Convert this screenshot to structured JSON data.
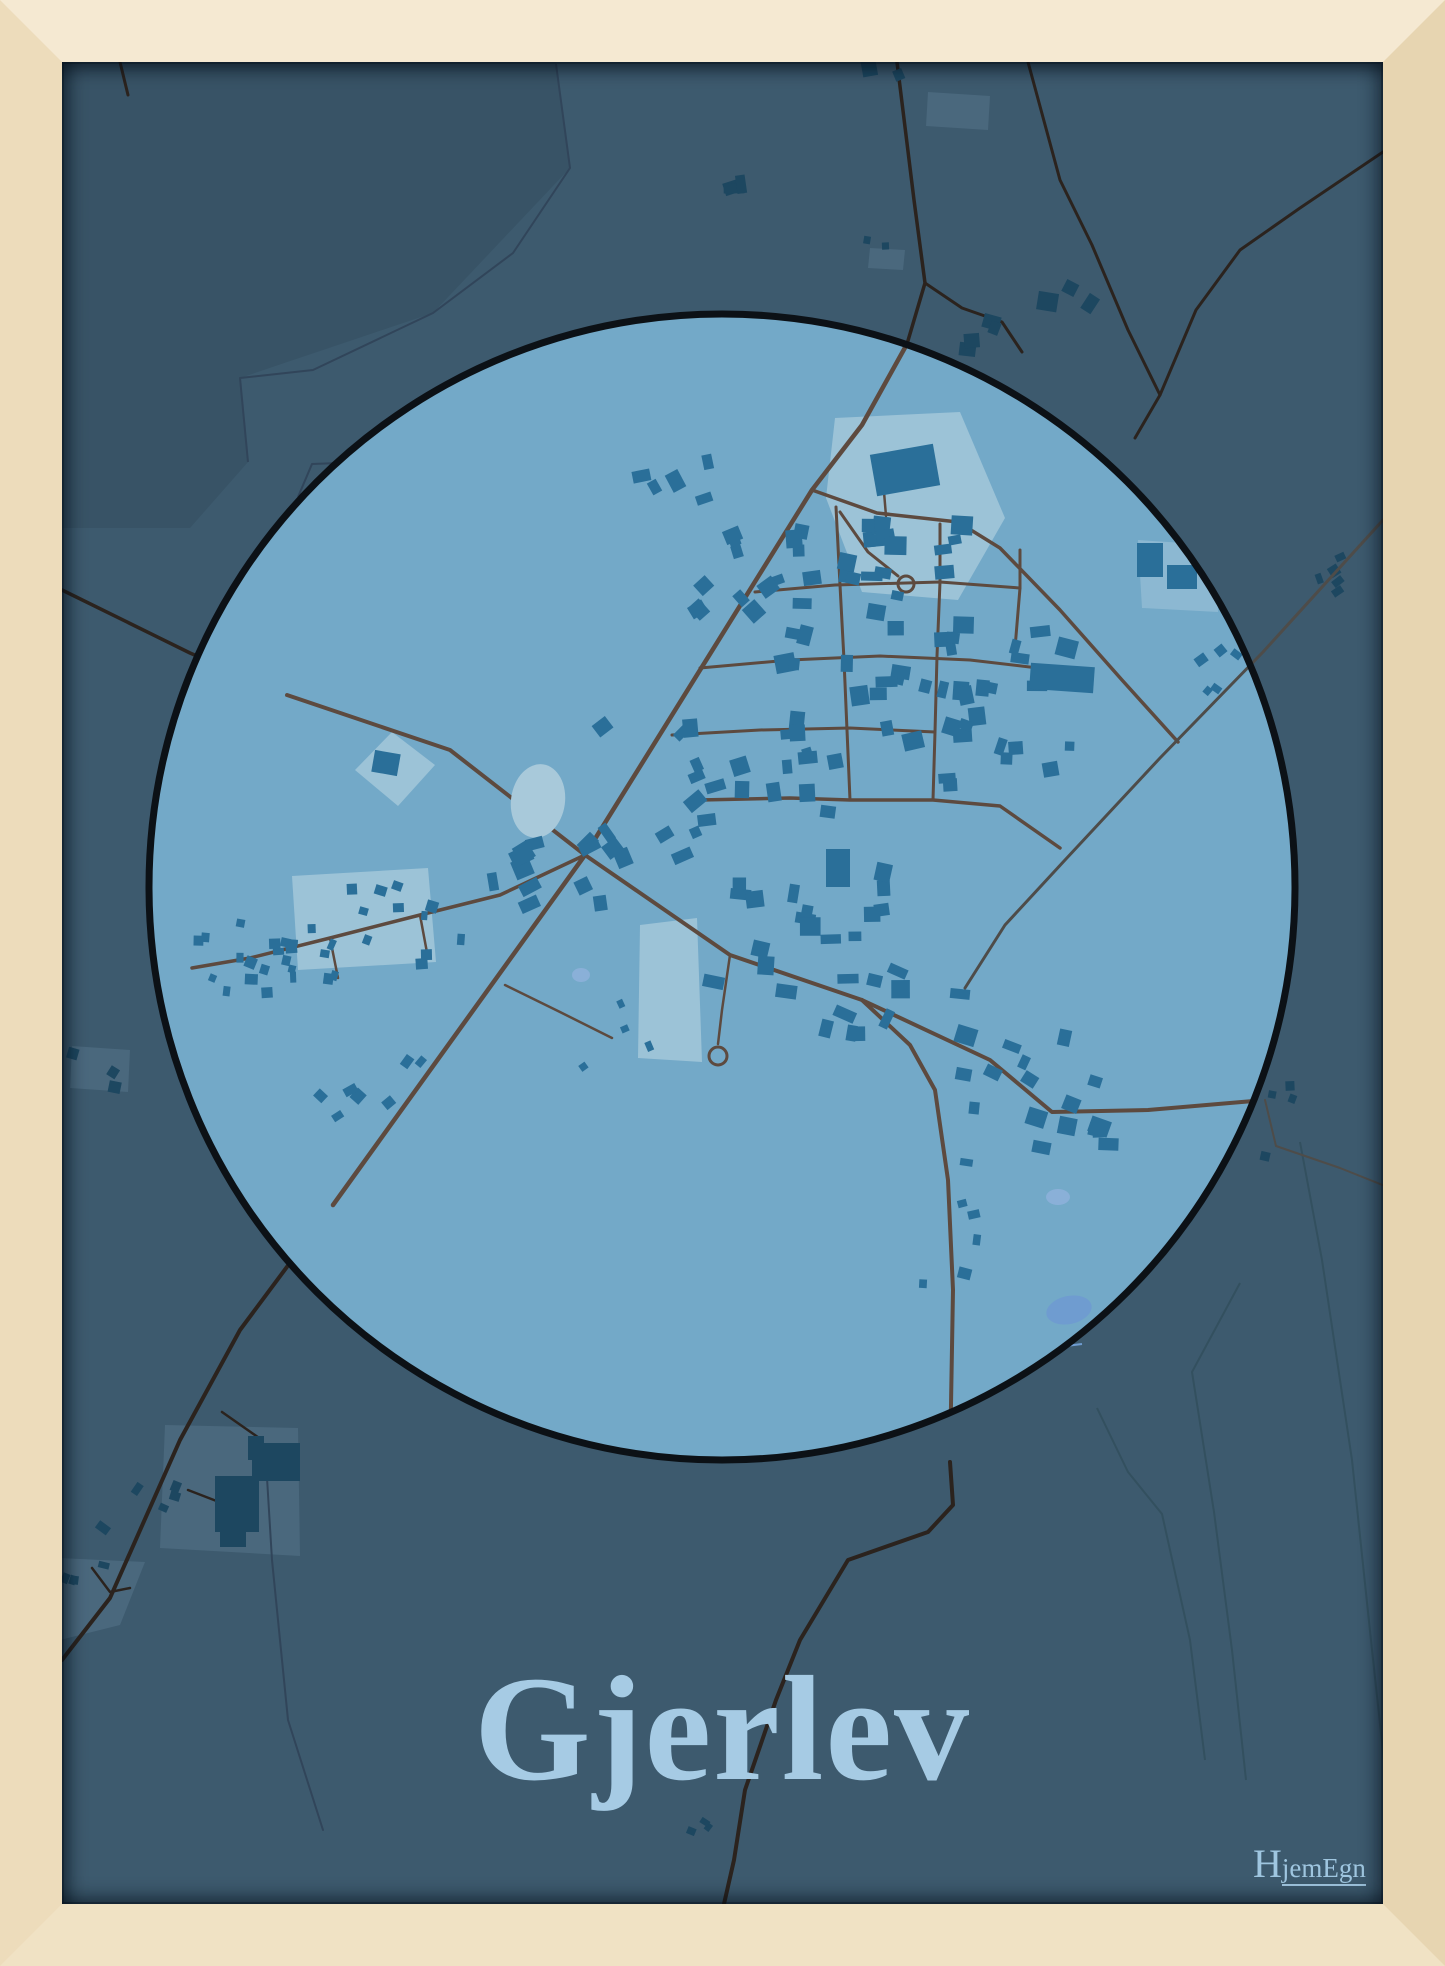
{
  "poster": {
    "title": "Gjerlev",
    "brand": {
      "first_letter": "H",
      "rest": "jemEgn"
    }
  },
  "colors": {
    "frame_top": "#f5e9d2",
    "frame_left": "#eddcbb",
    "frame_right": "#e7d5b1",
    "frame_bottom": "#f0e2c4",
    "poster_bg": "#3d5a6e",
    "overlay_dark": "rgba(16,28,38,0.10)",
    "circle_fill": "#73a9c8",
    "circle_outline": "#0c1116",
    "building_in": "#2a6f99",
    "building_out": "#1d4760",
    "patch_in": "#a5c8db",
    "patch_out": "#4b697e",
    "road_in": "#5d4a3f",
    "road_out": "#2b231e",
    "road_gray": "#4e4c49",
    "stream": "#31455a",
    "field_line": "#33505f",
    "pond": "#a8c9da",
    "lake1": "#6f9cd0",
    "lake2": "#8ab0d8",
    "title_color": "#a6cbe4",
    "brand_color": "#9fc6e0"
  },
  "map": {
    "viewbox": "62 62 1321 1842",
    "circle": {
      "cx": 722,
      "cy": 887,
      "r": 573,
      "outline_width": 7
    },
    "dark_overlay": "62,62 556,62 570,168 433,313 240,378 248,462 190,528 62,528",
    "streams": [
      {
        "pts": "556,64 570,168 513,253 433,313 313,370 240,378 248,462",
        "w": 2
      },
      {
        "pts": "467,402 417,460 312,464 298,497",
        "w": 2
      },
      {
        "pts": "1036,1338 1058,1347 1082,1344",
        "w": 2,
        "col": "lake1"
      }
    ],
    "field_lines": [
      "1240,1283 1192,1372 1214,1512 1232,1650 1246,1780",
      "1097,1408 1128,1472 1162,1514 1190,1640 1205,1760",
      "1300,1142 1322,1260 1352,1460 1372,1650 1385,1770"
    ],
    "roads_out": [
      {
        "pts": "897,62 914,200 925,283 907,344",
        "w": 3.5
      },
      {
        "pts": "925,283 962,308 1002,322 1022,352",
        "w": 3
      },
      {
        "pts": "1028,62 1060,180 1092,245 1128,330 1160,395 1135,438",
        "w": 3
      },
      {
        "pts": "1383,152 1300,208 1240,250 1196,310 1160,395",
        "w": 3
      },
      {
        "pts": "120,62 128,95",
        "w": 3
      },
      {
        "pts": "950,1462 953,1505 928,1532 848,1560 800,1640 776,1700 745,1790 734,1860 724,1904",
        "w": 4
      },
      {
        "pts": "333,1205 240,1330 180,1440 110,1598 62,1660",
        "w": 4
      },
      {
        "pts": "188,1490 245,1512",
        "w": 2.5
      },
      {
        "pts": "222,1412 262,1440 258,1470",
        "w": 2.5
      },
      {
        "pts": "92,1568 110,1592 130,1588",
        "w": 2.5
      },
      {
        "pts": "62,590 190,653 287,695",
        "w": 3.5
      },
      {
        "pts": "265,1445 272,1560 288,1720 323,1830",
        "w": 2,
        "col": "stream"
      },
      {
        "pts": "1265,1100 1276,1146 1340,1168 1385,1186",
        "w": 2,
        "col": "road_gray"
      }
    ],
    "roads_mid": [
      {
        "pts": "1383,520 1263,652 1160,758 1065,860 1005,925 965,988",
        "w": 3,
        "col": "road_gray"
      }
    ],
    "roads_in": [
      {
        "pts": "907,344 862,425 812,490 585,855 333,1205",
        "w": 4.5
      },
      {
        "pts": "287,695 450,750 585,855 730,955 862,1000 990,1060 1052,1112 1148,1110 1265,1100",
        "w": 4
      },
      {
        "pts": "812,490 877,513 958,522 1000,548 1060,610 1122,680 1178,742",
        "w": 3.5
      },
      {
        "pts": "840,512 868,552 898,576",
        "w": 3
      },
      {
        "pts": "884,492 886,516",
        "w": 2.5
      },
      {
        "pts": "755,592 835,585 940,582 1020,588",
        "w": 3
      },
      {
        "pts": "700,668 790,660 880,656 970,660 1038,668",
        "w": 3
      },
      {
        "pts": "672,735 760,730 850,728 935,732",
        "w": 3
      },
      {
        "pts": "836,507 840,585 844,660 847,730 850,800",
        "w": 3
      },
      {
        "pts": "940,524 940,582 937,656 935,732 933,800",
        "w": 3
      },
      {
        "pts": "1020,550 1020,588 1014,660",
        "w": 3
      },
      {
        "pts": "700,800 790,798 850,800 933,800 1000,806 1060,848",
        "w": 3.5
      },
      {
        "pts": "585,855 500,895 420,915 330,938 250,958 192,968",
        "w": 3.5
      },
      {
        "pts": "862,1000 910,1045 935,1090 948,1180 953,1290 950,1462",
        "w": 4
      },
      {
        "pts": "730,955 722,1010 718,1044",
        "w": 2.5
      },
      {
        "pts": "505,985 560,1012 612,1038",
        "w": 2.5
      },
      {
        "pts": "330,938 338,978",
        "w": 2.5
      },
      {
        "pts": "420,915 428,958",
        "w": 2.5
      }
    ],
    "culdesacs": [
      {
        "cx": 906,
        "cy": 584,
        "r": 8
      },
      {
        "cx": 718,
        "cy": 1056,
        "r": 9
      }
    ],
    "patches_in": [
      {
        "pts": "835,418 960,412 1005,518 958,600 862,592 826,498",
        "op": 0.82
      },
      {
        "pts": "292,876 428,868 436,962 298,970",
        "op": 0.82
      },
      {
        "pts": "355,770 392,732 435,765 398,806",
        "op": 0.82
      },
      {
        "pts": "640,925 697,918 702,1062 638,1058",
        "op": 0.82
      },
      {
        "pts": "1138,540 1215,545 1218,612 1142,608",
        "op": 0.5
      }
    ],
    "patches_out": [
      {
        "pts": "870,248 905,250 903,270 868,268",
        "op": 0.9
      },
      {
        "pts": "928,92 990,96 988,130 926,126",
        "op": 0.9
      },
      {
        "pts": "165,1425 298,1428 300,1556 160,1548",
        "op": 0.9
      },
      {
        "pts": "72,1046 130,1050 128,1092 70,1088",
        "op": 0.9
      },
      {
        "pts": "60,1558 145,1562 120,1625 60,1640",
        "op": 0.9
      }
    ],
    "lakes": [
      {
        "cx": 538,
        "cy": 801,
        "rx": 27,
        "ry": 37,
        "rot": 8,
        "fill": "pond"
      },
      {
        "cx": 1069,
        "cy": 1310,
        "rx": 23,
        "ry": 14,
        "rot": -12,
        "fill": "lake1"
      },
      {
        "cx": 1058,
        "cy": 1197,
        "rx": 12,
        "ry": 8,
        "rot": 0,
        "fill": "lake2"
      },
      {
        "cx": 581,
        "cy": 975,
        "rx": 9,
        "ry": 7,
        "rot": 0,
        "fill": "lake2"
      }
    ],
    "big_buildings_in": [
      [
        905,
        470,
        64,
        42,
        -10
      ],
      [
        812,
        578,
        18,
        14,
        -8
      ],
      [
        1062,
        678,
        64,
        26,
        4
      ],
      [
        1150,
        560,
        26,
        34,
        0
      ],
      [
        1182,
        577,
        30,
        24,
        0
      ],
      [
        386,
        763,
        26,
        22,
        10
      ],
      [
        838,
        868,
        24,
        38,
        0
      ]
    ],
    "big_buildings_out": [
      [
        237,
        1504,
        44,
        56,
        0
      ],
      [
        276,
        1462,
        48,
        38,
        0
      ],
      [
        233,
        1537,
        26,
        20,
        0
      ],
      [
        256,
        1448,
        16,
        24,
        0
      ]
    ],
    "clusters_in": [
      {
        "x": 745,
        "y": 565,
        "w": 95,
        "h": 130,
        "n": 10,
        "r": -30
      },
      {
        "x": 885,
        "y": 640,
        "w": 200,
        "h": 230,
        "n": 40,
        "r": 0
      },
      {
        "x": 1000,
        "y": 710,
        "w": 150,
        "h": 170,
        "n": 20,
        "r": 5
      },
      {
        "x": 765,
        "y": 770,
        "w": 150,
        "h": 110,
        "n": 15,
        "r": -5
      },
      {
        "x": 645,
        "y": 790,
        "w": 115,
        "h": 140,
        "n": 13,
        "r": -35
      },
      {
        "x": 550,
        "y": 870,
        "w": 115,
        "h": 85,
        "n": 9,
        "r": -20
      },
      {
        "x": 352,
        "y": 933,
        "w": 225,
        "h": 95,
        "n": 26,
        "r": 10,
        "s": [
          6,
          13
        ]
      },
      {
        "x": 243,
        "y": 963,
        "w": 90,
        "h": 65,
        "n": 8,
        "r": 10,
        "s": [
          6,
          12
        ]
      },
      {
        "x": 800,
        "y": 930,
        "w": 175,
        "h": 125,
        "n": 17,
        "r": 0
      },
      {
        "x": 905,
        "y": 1012,
        "w": 160,
        "h": 95,
        "n": 11,
        "r": 12
      },
      {
        "x": 1030,
        "y": 1080,
        "w": 135,
        "h": 85,
        "n": 9,
        "r": 18
      },
      {
        "x": 1088,
        "y": 1130,
        "w": 105,
        "h": 40,
        "n": 7,
        "r": 5
      },
      {
        "x": 950,
        "y": 1225,
        "w": 55,
        "h": 130,
        "n": 6,
        "r": 0,
        "s": [
          7,
          14
        ]
      },
      {
        "x": 372,
        "y": 1080,
        "w": 105,
        "h": 75,
        "n": 7,
        "r": -40,
        "s": [
          7,
          14
        ]
      },
      {
        "x": 683,
        "y": 478,
        "w": 85,
        "h": 65,
        "n": 5,
        "r": -25
      },
      {
        "x": 1228,
        "y": 672,
        "w": 55,
        "h": 45,
        "n": 5,
        "r": -40,
        "s": [
          6,
          12
        ]
      },
      {
        "x": 620,
        "y": 1035,
        "w": 75,
        "h": 65,
        "n": 4,
        "r": -30,
        "s": [
          6,
          12
        ]
      }
    ],
    "clusters_out": [
      {
        "x": 1000,
        "y": 333,
        "w": 65,
        "h": 48,
        "n": 4,
        "r": 8
      },
      {
        "x": 1085,
        "y": 298,
        "w": 75,
        "h": 36,
        "n": 3,
        "r": 20
      },
      {
        "x": 884,
        "y": 242,
        "w": 34,
        "h": 14,
        "n": 2,
        "r": 0,
        "s": [
          6,
          11
        ]
      },
      {
        "x": 888,
        "y": 80,
        "w": 38,
        "h": 34,
        "n": 2,
        "r": -10
      },
      {
        "x": 757,
        "y": 172,
        "w": 48,
        "h": 40,
        "n": 3,
        "r": -8
      },
      {
        "x": 1348,
        "y": 572,
        "w": 58,
        "h": 48,
        "n": 5,
        "r": -30,
        "s": [
          6,
          12
        ]
      },
      {
        "x": 1290,
        "y": 1097,
        "w": 36,
        "h": 24,
        "n": 3,
        "r": 10,
        "s": [
          6,
          11
        ]
      },
      {
        "x": 100,
        "y": 1068,
        "w": 55,
        "h": 42,
        "n": 3,
        "r": 25,
        "s": [
          7,
          13
        ]
      },
      {
        "x": 140,
        "y": 1505,
        "w": 75,
        "h": 55,
        "n": 5,
        "r": 25,
        "s": [
          7,
          14
        ]
      },
      {
        "x": 88,
        "y": 1572,
        "w": 46,
        "h": 36,
        "n": 4,
        "r": 20,
        "s": [
          6,
          12
        ]
      },
      {
        "x": 710,
        "y": 1833,
        "w": 38,
        "h": 28,
        "n": 3,
        "r": 30,
        "s": [
          6,
          11
        ]
      },
      {
        "x": 1272,
        "y": 1160,
        "w": 14,
        "h": 12,
        "n": 1,
        "r": 0,
        "s": [
          7,
          10
        ]
      }
    ]
  }
}
